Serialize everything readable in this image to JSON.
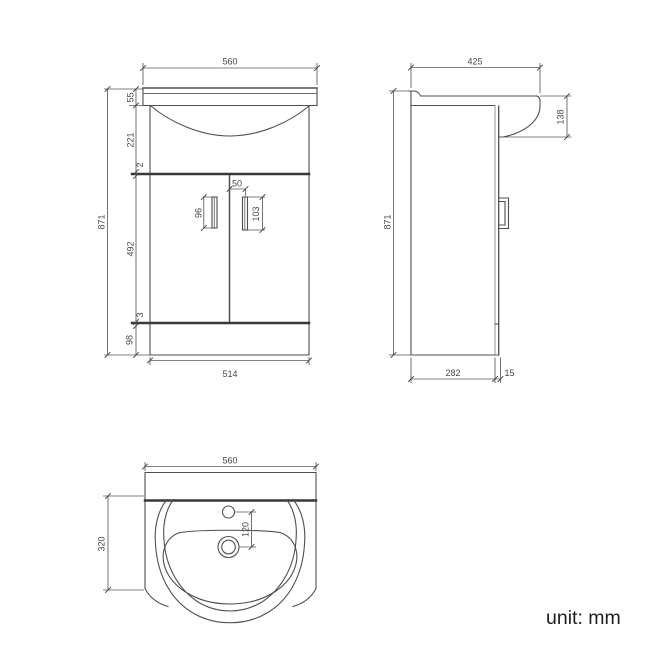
{
  "unit_label": "unit: mm",
  "front": {
    "top_width": "560",
    "counter_height": "55",
    "basin_height": "221",
    "top_gap": "2",
    "overall_height": "871",
    "door_height": "492",
    "bottom_gap": "3",
    "plinth_height": "98",
    "left_handle_height": "96",
    "handle_offset": "50",
    "right_handle_height": "103",
    "cabinet_width": "514"
  },
  "side": {
    "top_depth": "425",
    "basin_overhang": "138",
    "overall_height": "871",
    "cabinet_depth": "282",
    "door_thickness": "15"
  },
  "plan": {
    "top_width": "560",
    "depth": "320",
    "tap_to_drain": "120"
  }
}
